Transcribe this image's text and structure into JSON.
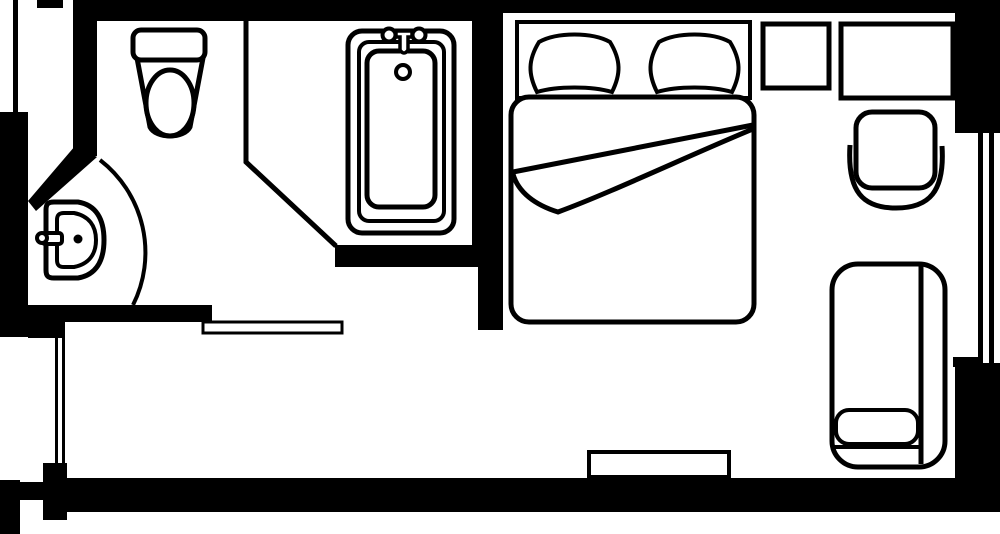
{
  "plan": {
    "kind": "hotel-room-floor-plan",
    "canvas": {
      "width": 1000,
      "height": 534,
      "background": "#ffffff",
      "ink": "#000000"
    },
    "rooms": [
      {
        "name": "bathroom"
      },
      {
        "name": "bedroom"
      }
    ],
    "shapes": [
      {
        "name": "top-wall",
        "type": "rect",
        "x": 77,
        "y": 0,
        "w": 923,
        "h": 13,
        "f": "#000000"
      },
      {
        "name": "top-wall-bathroom-section",
        "type": "rect",
        "x": 77,
        "y": 13,
        "w": 426,
        "h": 8,
        "f": "#000000"
      },
      {
        "name": "top-left-wall-stub",
        "type": "rect",
        "x": 37,
        "y": 0,
        "w": 26,
        "h": 8,
        "f": "#000000"
      },
      {
        "name": "top-left-window-line",
        "type": "rect",
        "x": 13,
        "y": 0,
        "w": 5,
        "h": 118,
        "f": "#000000"
      },
      {
        "name": "left-wall-upper",
        "type": "rect",
        "x": 0,
        "y": 112,
        "w": 28,
        "h": 225,
        "f": "#000000"
      },
      {
        "name": "bathroom-left-wall",
        "type": "rect",
        "x": 73,
        "y": 0,
        "w": 24,
        "h": 156,
        "f": "#000000"
      },
      {
        "name": "bathroom-diagonal-wall",
        "type": "polygon",
        "points": "75,146 97,157 36,211 28,201",
        "f": "#000000"
      },
      {
        "name": "bathroom-bedroom-partition-upper",
        "type": "rect",
        "x": 472,
        "y": 13,
        "w": 31,
        "h": 254,
        "f": "#000000"
      },
      {
        "name": "wall-below-bathtub",
        "type": "rect",
        "x": 335,
        "y": 245,
        "w": 168,
        "h": 22,
        "f": "#000000"
      },
      {
        "name": "bathroom-bedroom-partition-lower",
        "type": "rect",
        "x": 478,
        "y": 267,
        "w": 25,
        "h": 63,
        "f": "#000000"
      },
      {
        "name": "bathroom-south-wall",
        "type": "rect",
        "x": 27,
        "y": 305,
        "w": 185,
        "h": 17,
        "f": "#000000"
      },
      {
        "name": "left-wall-jog",
        "type": "rect",
        "x": 28,
        "y": 318,
        "w": 37,
        "h": 20,
        "f": "#000000"
      },
      {
        "name": "left-window-line-outer",
        "type": "rect",
        "x": 55,
        "y": 338,
        "w": 3,
        "h": 125,
        "f": "#000000"
      },
      {
        "name": "left-window-line-inner",
        "type": "rect",
        "x": 62,
        "y": 338,
        "w": 3,
        "h": 125,
        "f": "#000000"
      },
      {
        "name": "left-wall-pier",
        "type": "rect",
        "x": 43,
        "y": 463,
        "w": 24,
        "h": 57,
        "f": "#000000"
      },
      {
        "name": "bottom-wall",
        "type": "rect",
        "x": 65,
        "y": 478,
        "w": 900,
        "h": 34,
        "f": "#000000"
      },
      {
        "name": "bottom-left-wall-stub",
        "type": "rect",
        "x": 0,
        "y": 480,
        "w": 20,
        "h": 54,
        "f": "#000000"
      },
      {
        "name": "bottom-left-wall-step",
        "type": "rect",
        "x": 20,
        "y": 482,
        "w": 25,
        "h": 18,
        "f": "#000000"
      },
      {
        "name": "top-right-corner-wall",
        "type": "rect",
        "x": 955,
        "y": 0,
        "w": 45,
        "h": 133,
        "f": "#000000"
      },
      {
        "name": "right-window-line-outer",
        "type": "rect",
        "x": 989,
        "y": 127,
        "w": 5,
        "h": 237,
        "f": "#000000"
      },
      {
        "name": "right-window-line-inner",
        "type": "rect",
        "x": 978,
        "y": 127,
        "w": 5,
        "h": 237,
        "f": "#000000"
      },
      {
        "name": "right-wall-step",
        "type": "rect",
        "x": 953,
        "y": 357,
        "w": 30,
        "h": 10,
        "f": "#000000"
      },
      {
        "name": "bottom-right-corner-wall",
        "type": "rect",
        "x": 955,
        "y": 363,
        "w": 45,
        "h": 149,
        "f": "#000000"
      },
      {
        "name": "toilet-tub-partition-line",
        "type": "path",
        "d": "M 246 20 L 246 162 L 336 246",
        "s": "#000000",
        "sw": 5,
        "f": "none"
      },
      {
        "name": "bathroom-door-threshold",
        "type": "rect",
        "x": 203,
        "y": 322,
        "w": 139,
        "h": 11,
        "f": "#ffffff",
        "s": "#000000",
        "sw": 3
      },
      {
        "name": "bathroom-door-swing-arc",
        "type": "path",
        "d": "M 100 160 A 117 117 0 0 1 133 305",
        "s": "#000000",
        "sw": 4,
        "f": "none"
      },
      {
        "name": "toilet-bowl",
        "type": "path",
        "d": "M 137 58 L 150 127 C 156 139 184 139 190 127 L 203 58 Z",
        "f": "#ffffff",
        "s": "#000000",
        "sw": 5
      },
      {
        "name": "toilet-bowl-inner",
        "type": "ellipse",
        "cx": 170,
        "cy": 103,
        "rx": 24,
        "ry": 33,
        "f": "#ffffff",
        "s": "#000000",
        "sw": 5
      },
      {
        "name": "toilet-tank",
        "type": "rect",
        "x": 133,
        "y": 30,
        "w": 72,
        "h": 30,
        "rx": 8,
        "f": "#ffffff",
        "s": "#000000",
        "sw": 5
      },
      {
        "name": "bathtub-outer-rim",
        "type": "rect",
        "x": 348,
        "y": 31,
        "w": 106,
        "h": 202,
        "rx": 14,
        "f": "#ffffff",
        "s": "#000000",
        "sw": 5
      },
      {
        "name": "bathtub-mid-rim",
        "type": "rect",
        "x": 359,
        "y": 42,
        "w": 85,
        "h": 179,
        "rx": 10,
        "f": "#ffffff",
        "s": "#000000",
        "sw": 4
      },
      {
        "name": "bathtub-basin",
        "type": "rect",
        "x": 367,
        "y": 51,
        "w": 68,
        "h": 156,
        "rx": 12,
        "f": "#ffffff",
        "s": "#000000",
        "sw": 5
      },
      {
        "name": "bathtub-faucet-bar",
        "type": "path",
        "d": "M 383 35 L 425 35",
        "s": "#000000",
        "sw": 4,
        "f": "none"
      },
      {
        "name": "bathtub-faucet-handle-left",
        "type": "circle",
        "cx": 389,
        "cy": 35,
        "r": 6.5,
        "f": "#ffffff",
        "s": "#000000",
        "sw": 4
      },
      {
        "name": "bathtub-faucet-handle-right",
        "type": "circle",
        "cx": 419,
        "cy": 35,
        "r": 6.5,
        "f": "#ffffff",
        "s": "#000000",
        "sw": 4
      },
      {
        "name": "bathtub-spout",
        "type": "path",
        "d": "M 396 31 L 412 31 L 412 37 L 408 37 L 408 50 Q 404 56 400 50 L 400 37 L 396 37 Z",
        "f": "#ffffff",
        "s": "#000000",
        "sw": 3.5
      },
      {
        "name": "bathtub-drain",
        "type": "circle",
        "cx": 403,
        "cy": 72,
        "r": 7,
        "f": "#ffffff",
        "s": "#000000",
        "sw": 4
      },
      {
        "name": "sink-basin-outer",
        "type": "path",
        "d": "M 54 202 L 78 202 C 96 205 104 219 104 240 C 104 261 96 275 78 278 L 54 278 C 48 278 46 276 46 270 L 46 210 C 46 204 48 202 54 202 Z",
        "f": "#ffffff",
        "s": "#000000",
        "sw": 5
      },
      {
        "name": "sink-basin-inner",
        "type": "path",
        "d": "M 64 213 L 74 213 C 89 216 96 226 96 240 C 96 254 89 264 74 267 L 64 267 C 59 267 57 265 57 260 L 57 220 C 57 215 59 213 64 213 Z",
        "f": "#ffffff",
        "s": "#000000",
        "sw": 4
      },
      {
        "name": "sink-faucet-bar",
        "type": "rect",
        "x": 42,
        "y": 233,
        "w": 20,
        "h": 11,
        "rx": 3,
        "f": "#ffffff",
        "s": "#000000",
        "sw": 4
      },
      {
        "name": "sink-faucet-knob",
        "type": "circle",
        "cx": 42,
        "cy": 238,
        "r": 5,
        "f": "#ffffff",
        "s": "#000000",
        "sw": 4
      },
      {
        "name": "sink-drain-dot",
        "type": "circle",
        "cx": 78,
        "cy": 239,
        "r": 4.5,
        "f": "#000000"
      },
      {
        "name": "bed-headboard",
        "type": "rect",
        "x": 517,
        "y": 22,
        "w": 233,
        "h": 76,
        "f": "#ffffff",
        "s": "#000000",
        "sw": 4
      },
      {
        "name": "bed-pillow-left",
        "type": "path",
        "d": "M 539 42 C 557 32 592 32 610 42 C 621 60 621 74 612 92 C 592 86 557 86 537 92 C 528 74 528 60 539 42 Z",
        "f": "#ffffff",
        "s": "#000000",
        "sw": 4
      },
      {
        "name": "bed-pillow-right",
        "type": "path",
        "d": "M 659 42 C 677 32 712 32 730 42 C 741 60 741 74 732 92 C 712 86 677 86 657 92 C 648 74 648 60 659 42 Z",
        "f": "#ffffff",
        "s": "#000000",
        "sw": 4
      },
      {
        "name": "bed-mattress",
        "type": "rect",
        "x": 511,
        "y": 97,
        "w": 243,
        "h": 225,
        "rx": 18,
        "f": "#ffffff",
        "s": "#000000",
        "sw": 5
      },
      {
        "name": "bed-sheet-fold-top-line",
        "type": "path",
        "d": "M 753 125 L 513 172",
        "s": "#000000",
        "sw": 5,
        "f": "none"
      },
      {
        "name": "bed-sheet-fold-curve",
        "type": "path",
        "d": "M 513 174 C 518 192 535 205 558 212 C 610 193 690 155 753 129",
        "s": "#000000",
        "sw": 5,
        "f": "none"
      },
      {
        "name": "nightstand",
        "type": "rect",
        "x": 763,
        "y": 24,
        "w": 66,
        "h": 64,
        "f": "#ffffff",
        "s": "#000000",
        "sw": 5
      },
      {
        "name": "desk",
        "type": "rect",
        "x": 841,
        "y": 24,
        "w": 112,
        "h": 74,
        "f": "#ffffff",
        "s": "#000000",
        "sw": 5
      },
      {
        "name": "chair-armrest",
        "type": "path",
        "d": "M 850 145 C 847 192 863 208 896 208 C 929 208 945 192 942 146",
        "s": "#000000",
        "sw": 5,
        "f": "#ffffff"
      },
      {
        "name": "chair-seat",
        "type": "rect",
        "x": 856,
        "y": 112,
        "w": 79,
        "h": 76,
        "rx": 16,
        "f": "#ffffff",
        "s": "#000000",
        "sw": 5
      },
      {
        "name": "chaise-body",
        "type": "rect",
        "x": 832,
        "y": 264,
        "w": 113,
        "h": 203,
        "rx": 26,
        "f": "#ffffff",
        "s": "#000000",
        "sw": 5
      },
      {
        "name": "chaise-arm-line",
        "type": "path",
        "d": "M 921 266 L 921 464",
        "s": "#000000",
        "sw": 5,
        "f": "none"
      },
      {
        "name": "chaise-pillow",
        "type": "rect",
        "x": 836,
        "y": 410,
        "w": 82,
        "h": 34,
        "rx": 13,
        "f": "#ffffff",
        "s": "#000000",
        "sw": 4
      },
      {
        "name": "chaise-seat-line",
        "type": "path",
        "d": "M 834 447 L 919 447",
        "s": "#000000",
        "sw": 4,
        "f": "none"
      },
      {
        "name": "console-shelf",
        "type": "rect",
        "x": 589,
        "y": 452,
        "w": 140,
        "h": 25,
        "f": "#ffffff",
        "s": "#000000",
        "sw": 4
      }
    ]
  }
}
